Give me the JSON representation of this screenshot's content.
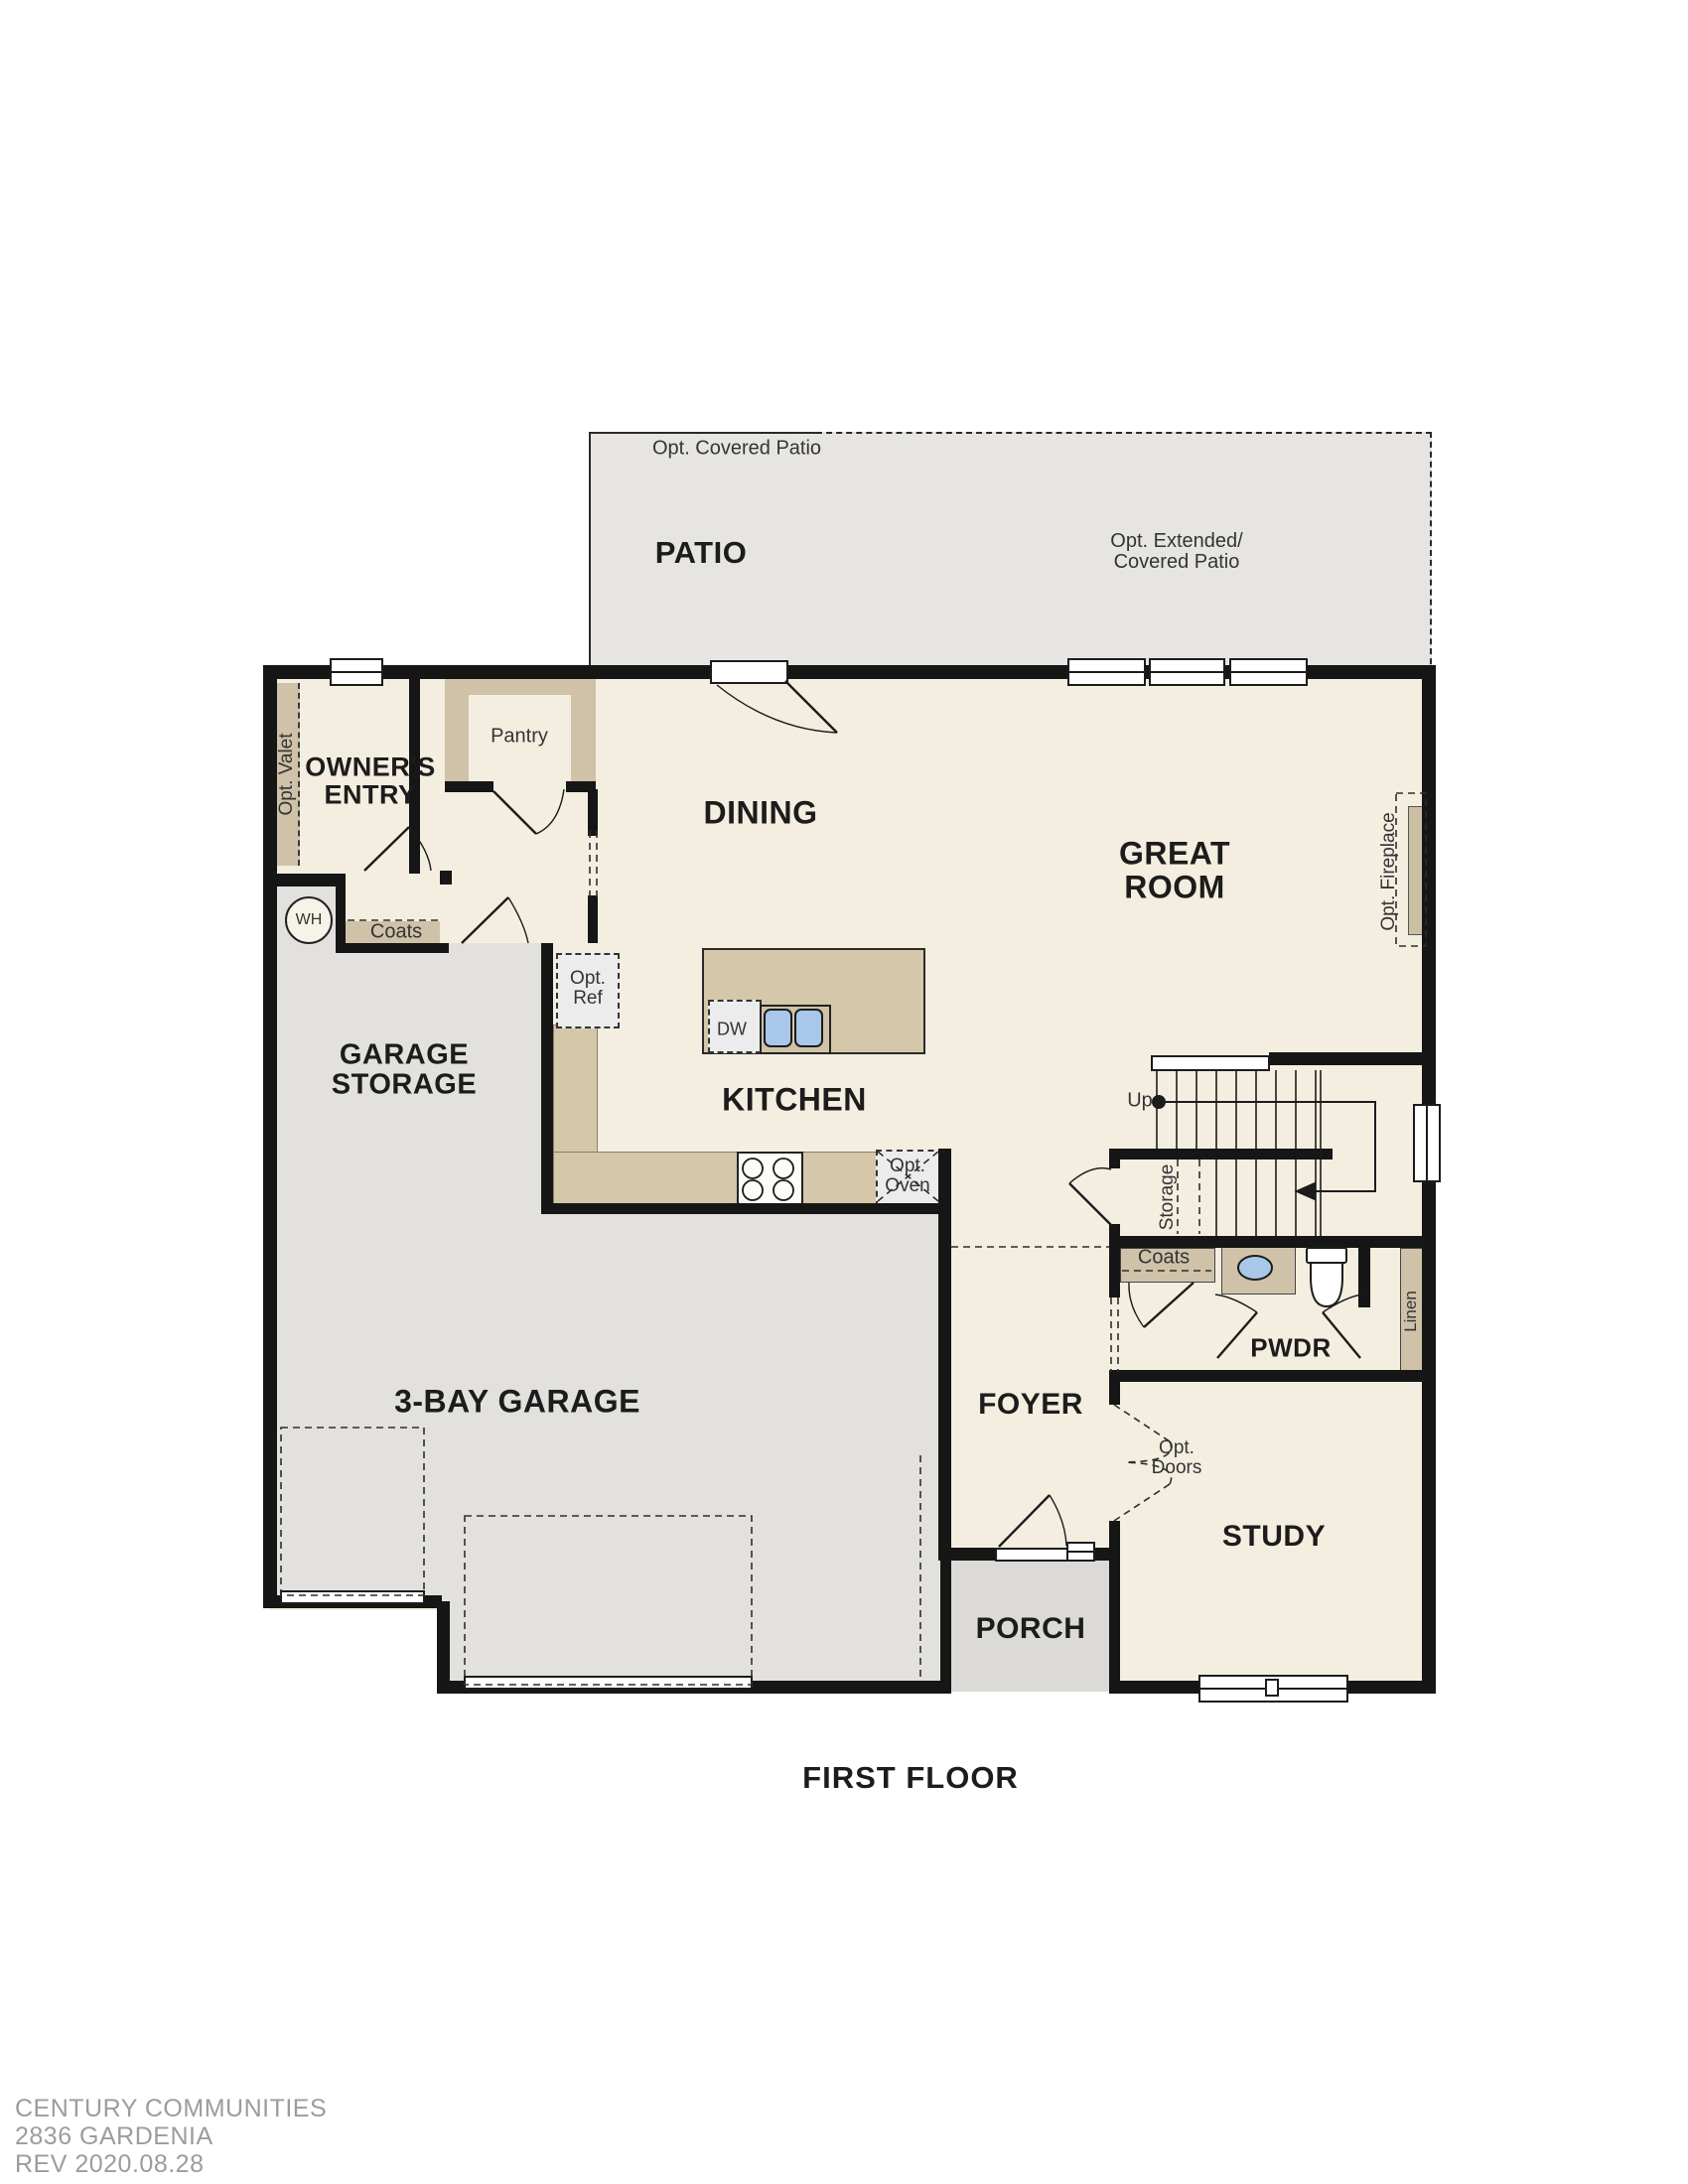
{
  "title": "FIRST FLOOR",
  "patio": {
    "label": "PATIO",
    "opt_covered": "Opt. Covered Patio",
    "opt_extended_1": "Opt. Extended/",
    "opt_extended_2": "Covered Patio"
  },
  "rooms": {
    "dining": "DINING",
    "great_room_1": "GREAT",
    "great_room_2": "ROOM",
    "kitchen": "KITCHEN",
    "owners_entry_1": "OWNER'S",
    "owners_entry_2": "ENTRY",
    "garage_storage_1": "GARAGE",
    "garage_storage_2": "STORAGE",
    "garage": "3-BAY GARAGE",
    "foyer": "FOYER",
    "study": "STUDY",
    "porch": "PORCH",
    "pwdr": "PWDR"
  },
  "annotations": {
    "pantry": "Pantry",
    "opt_valet": "Opt. Valet",
    "coats_entry": "Coats",
    "wh": "WH",
    "opt_ref_1": "Opt.",
    "opt_ref_2": "Ref",
    "dw": "DW",
    "opt_oven_1": "Opt.",
    "opt_oven_2": "Oven",
    "up": "Up",
    "storage": "Storage",
    "opt_fireplace": "Opt. Fireplace",
    "coats_hall": "Coats",
    "linen": "Linen",
    "opt_doors_1": "Opt.",
    "opt_doors_2": "Doors"
  },
  "footer": {
    "line1": "CENTURY COMMUNITIES",
    "line2": "2836 GARDENIA",
    "line3": "REV 2020.08.28"
  },
  "colors": {
    "wall": "#161616",
    "floor": "#f4eee0",
    "garage": "#e3e1dd",
    "porch": "#dcdad6",
    "patio": "#e7e5e2",
    "tan": "#cfc2a9",
    "counter": "#d5c7a9",
    "sink_blue": "#a9c8e9",
    "footer_text": "#9c9c9c"
  }
}
